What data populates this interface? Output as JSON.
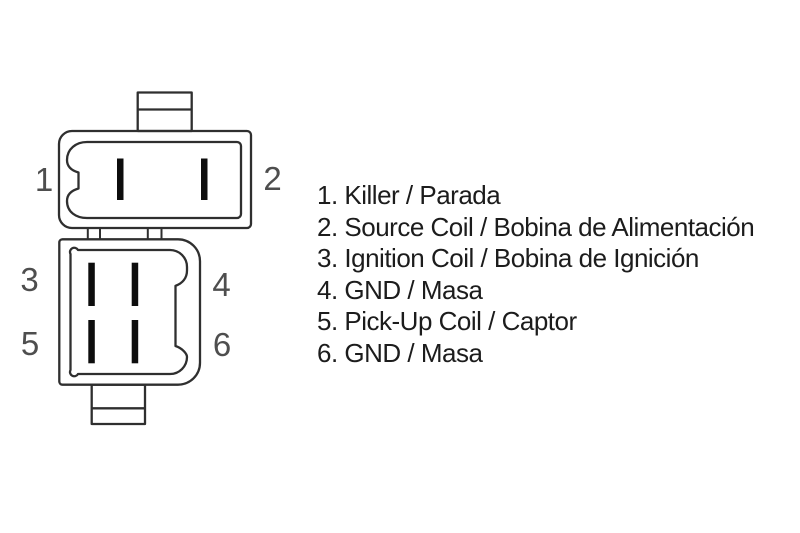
{
  "diagram": {
    "pin_labels": [
      "1",
      "2",
      "3",
      "4",
      "5",
      "6"
    ]
  },
  "legend": {
    "items": [
      "1. Killer / Parada",
      "2. Source Coil / Bobina de Alimentación",
      "3. Ignition Coil / Bobina de Ignición",
      "4. GND / Masa",
      "5. Pick-Up Coil / Captor",
      "6. GND / Masa"
    ]
  },
  "colors": {
    "background": "#ffffff",
    "line": "#2f2f2f",
    "pin_fill": "#0d0d0d",
    "pin_label": "#4e4e4e",
    "legend_text": "#1c1c1c"
  }
}
